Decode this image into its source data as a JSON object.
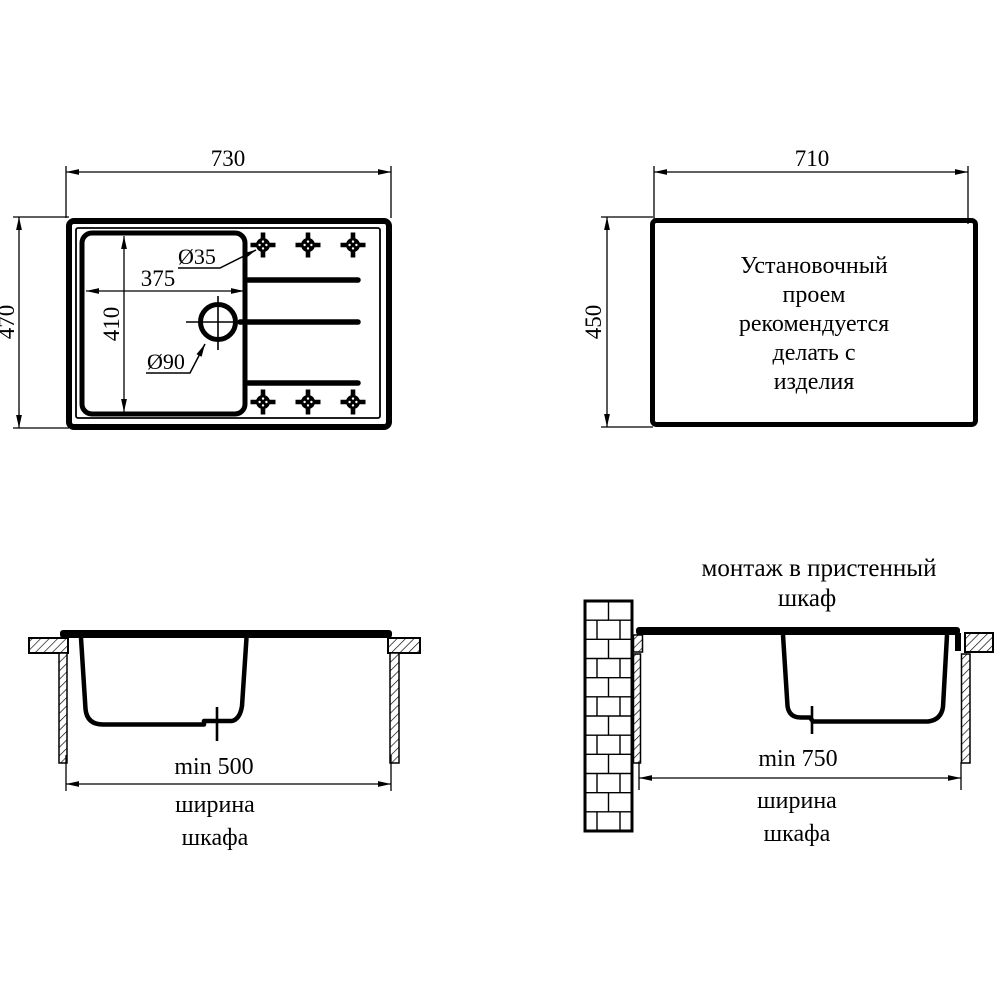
{
  "drawing": {
    "background_color": "#ffffff",
    "line_color": "#000000",
    "views": {
      "top_plan": {
        "width_label": "730",
        "height_label": "470",
        "bowl_width_label": "375",
        "bowl_height_label": "410",
        "faucet_hole_label": "Ø35",
        "drain_label": "Ø90"
      },
      "cutout": {
        "width_label": "710",
        "height_label": "450",
        "note_lines": [
          "Установочный",
          "проем",
          "рекомендуется",
          "делать с",
          "изделия"
        ]
      },
      "section_standard": {
        "min_width_label": "min 500",
        "caption_line1": "ширина",
        "caption_line2": "шкафа"
      },
      "section_wall": {
        "title_line1": "монтаж в пристенный",
        "title_line2": "шкаф",
        "min_width_label": "min 750",
        "caption_line1": "ширина",
        "caption_line2": "шкафа"
      }
    }
  }
}
